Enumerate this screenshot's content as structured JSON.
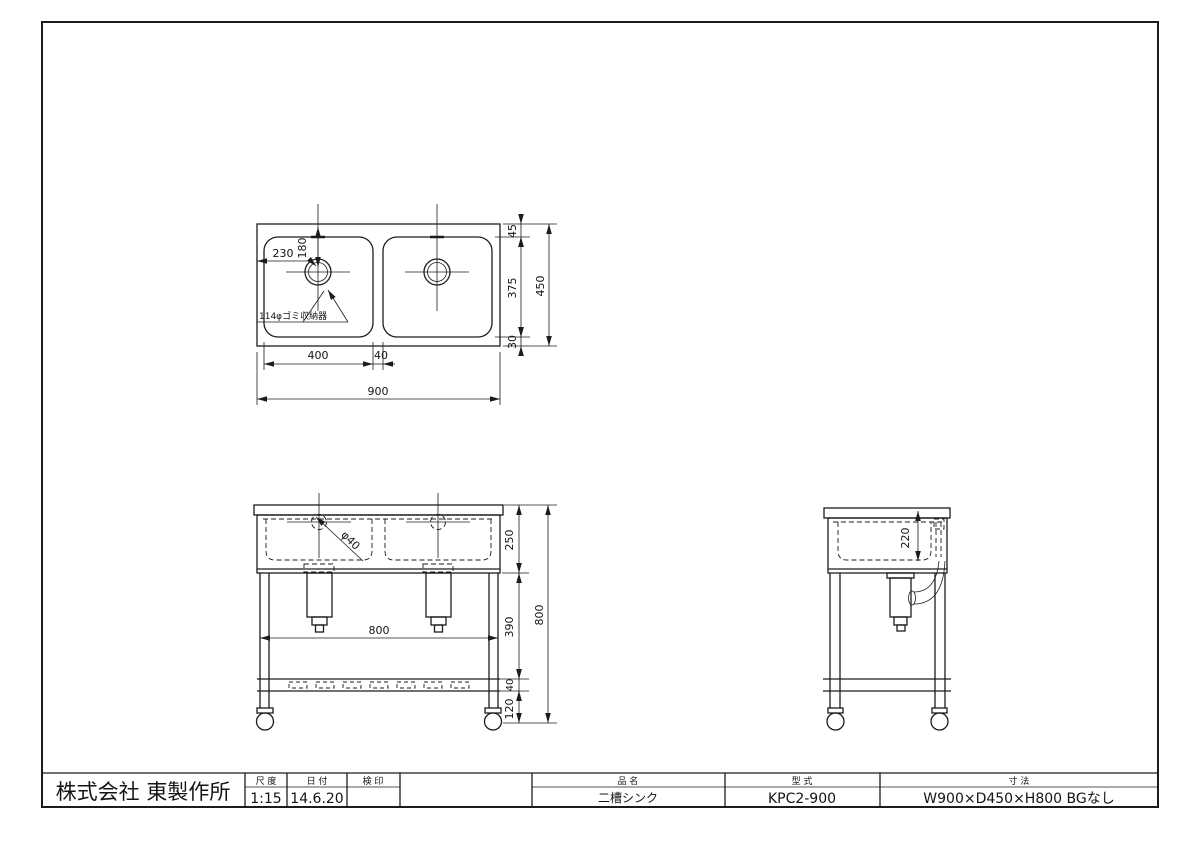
{
  "drawing": {
    "plan": {
      "note_garbage": "114φゴミ収納器",
      "dim_drain_offset_x": "230",
      "dim_drain_offset_y": "180",
      "dim_top_margin": "45",
      "dim_basin_depth": "375",
      "dim_bottom_margin": "30",
      "dim_overall_depth": "450",
      "dim_basin_width": "400",
      "dim_partition_gap": "40",
      "dim_overall_width": "900"
    },
    "front": {
      "dim_drain_diameter": "φ40",
      "dim_basin_height": "250",
      "dim_leg_upper": "390",
      "dim_shelf_height": "40",
      "dim_leg_lower": "120",
      "dim_overall_height": "800",
      "dim_leg_span": "800"
    },
    "side": {
      "dim_basin_inner_depth": "220"
    }
  },
  "title_block": {
    "company": "株式会社  東製作所",
    "scale_label": "尺 度",
    "scale_value": "1:15",
    "date_label": "日 付",
    "date_value": "14.6.20",
    "stamp_label": "検 印",
    "stamp_value": "",
    "name_label": "品  名",
    "name_value": "二槽シンク",
    "model_label": "型  式",
    "model_value": "KPC2-900",
    "size_label": "寸  法",
    "size_value": "W900×D450×H800 BGなし"
  }
}
